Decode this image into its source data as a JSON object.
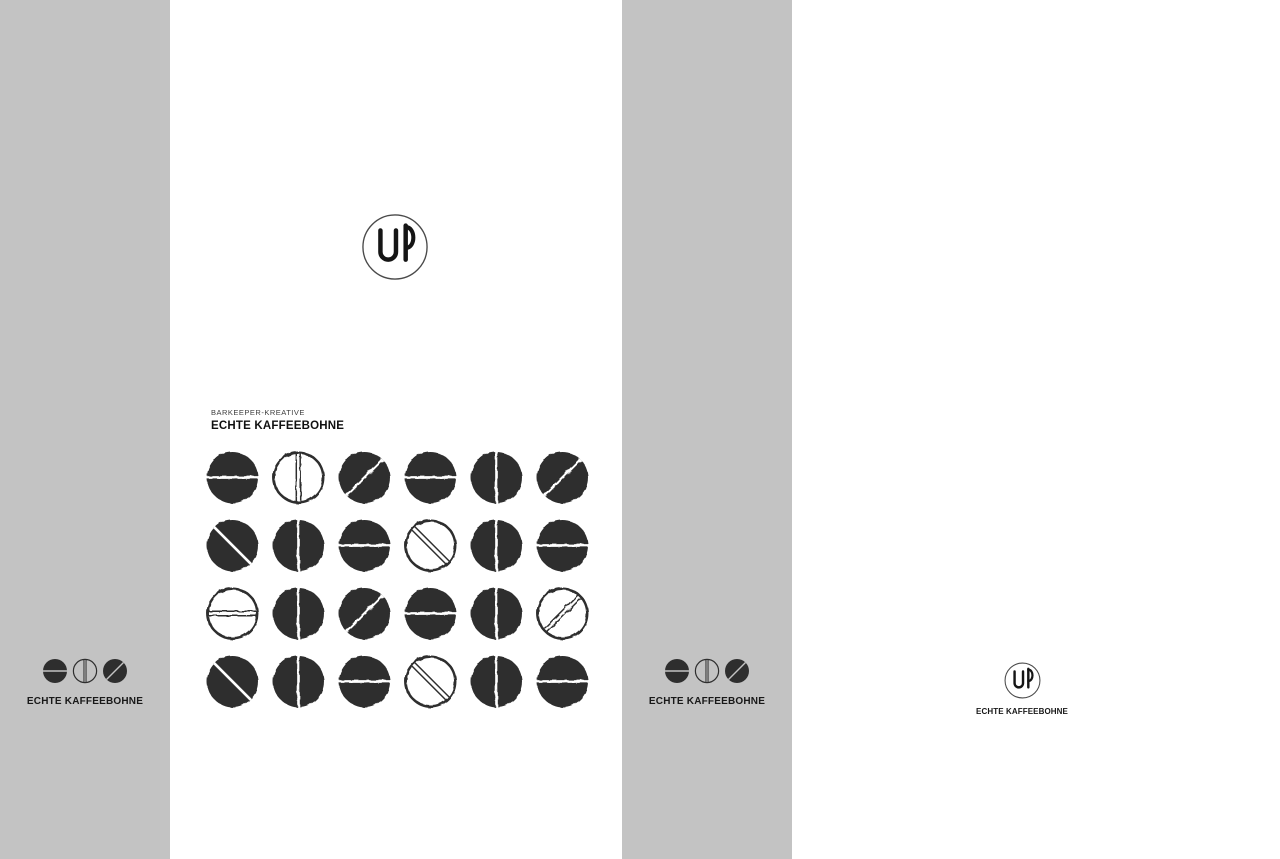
{
  "brand": {
    "monogram": "UP",
    "eyebrow": "BARKEEPER-KREATIVE",
    "name": "ECHTE KAFFEEBOHNE"
  },
  "colors": {
    "panel_gray": "#c3c3c3",
    "white": "#ffffff",
    "bean_ink": "#2e2e2e",
    "text_dark": "#181818"
  },
  "panels": {
    "left_gray": {
      "wordmark": "ECHTE KAFFEEBOHNE"
    },
    "center_white": {
      "eyebrow": "BARKEEPER-KREATIVE",
      "title": "ECHTE KAFFEEBOHNE"
    },
    "mid_gray": {
      "wordmark": "ECHTE KAFFEEBOHNE"
    },
    "right_white": {
      "wordmark": "ECHTE KAFFEEBOHNE"
    }
  },
  "bean_logo": [
    "solid-horizontal",
    "outline-vertical",
    "solid-diagonal-up"
  ],
  "bean_grid": {
    "rows": 4,
    "cols": 6,
    "cells": [
      [
        "solid-horizontal",
        "outline-vertical",
        "solid-diagonal-up",
        "solid-horizontal",
        "solid-vertical",
        "solid-diagonal-up"
      ],
      [
        "solid-diagonal-down",
        "solid-vertical",
        "solid-horizontal",
        "outline-diagonal-down",
        "solid-vertical",
        "solid-horizontal"
      ],
      [
        "outline-horizontal",
        "solid-vertical",
        "solid-diagonal-up",
        "solid-horizontal",
        "solid-vertical",
        "outline-diagonal-up"
      ],
      [
        "solid-diagonal-down",
        "solid-vertical",
        "solid-horizontal",
        "outline-diagonal-down",
        "solid-vertical",
        "solid-horizontal"
      ]
    ]
  }
}
